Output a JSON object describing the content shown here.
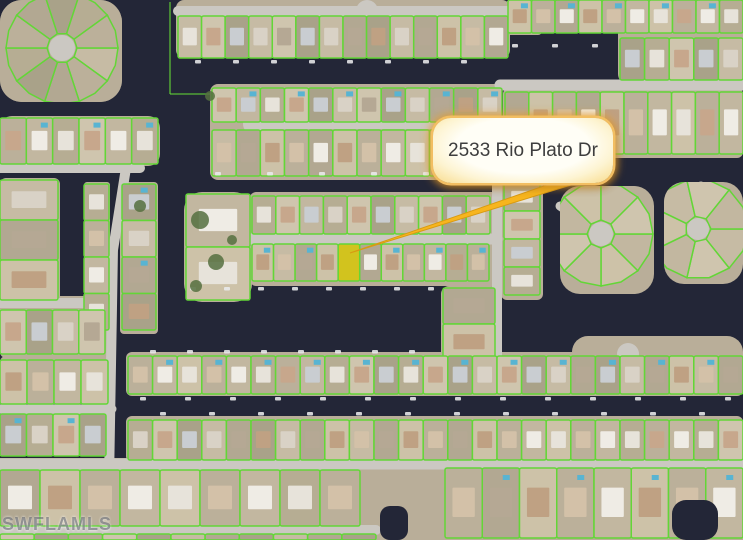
{
  "callout": {
    "label": "2533 Rio Plato Dr"
  },
  "watermark": {
    "text": "SWFLAMLS"
  },
  "map": {
    "width": 743,
    "height": 540,
    "colors": {
      "water": "#232637",
      "street": "#cbc8c2",
      "lot_line": "#63d637",
      "ground": "#b9ae99",
      "lot_fills": [
        "#c6bba4",
        "#bbb09a",
        "#cfc5ae",
        "#b2a892",
        "#c2b7a0",
        "#a9a289",
        "#cdc2a8",
        "#b6ad93"
      ],
      "house_fills": [
        "#e7e3da",
        "#d9d2c6",
        "#d3c1a8",
        "#c7a78c",
        "#b5a894",
        "#efece5",
        "#c9cdd1",
        "#bfa183"
      ],
      "pool": "#58b4d2",
      "boat": "#e9eaec",
      "tree": "#55703f",
      "highlight": "#d4c414",
      "arrow_fill": "#f7b51e",
      "arrow_edge": "#d89a12"
    },
    "ground_rects": [
      [
        0,
        0,
        122,
        102,
        22
      ],
      [
        176,
        0,
        334,
        58,
        8
      ],
      [
        506,
        0,
        36,
        35,
        4
      ],
      [
        544,
        0,
        0,
        0,
        0
      ],
      [
        618,
        0,
        125,
        84,
        10
      ],
      [
        503,
        88,
        240,
        70,
        6
      ],
      [
        210,
        84,
        292,
        96,
        8
      ],
      [
        250,
        192,
        250,
        94,
        6
      ],
      [
        501,
        150,
        42,
        150,
        6
      ],
      [
        441,
        286,
        58,
        76,
        8
      ],
      [
        0,
        116,
        160,
        50,
        12
      ],
      [
        0,
        178,
        60,
        124,
        6
      ],
      [
        84,
        182,
        26,
        150,
        3
      ],
      [
        120,
        182,
        38,
        152,
        4
      ],
      [
        184,
        192,
        68,
        110,
        18
      ],
      [
        0,
        296,
        112,
        62,
        6
      ],
      [
        126,
        352,
        617,
        44,
        6
      ],
      [
        0,
        356,
        110,
        48,
        6
      ],
      [
        126,
        416,
        617,
        46,
        6
      ],
      [
        0,
        410,
        108,
        46,
        6
      ],
      [
        0,
        458,
        743,
        82,
        0
      ],
      [
        572,
        336,
        171,
        58,
        16
      ]
    ],
    "streets": [
      [
        178,
        11,
        508,
        11,
        10
      ],
      [
        253,
        124,
        540,
        124,
        10
      ],
      [
        500,
        85,
        743,
        85,
        11
      ],
      [
        250,
        239,
        497,
        239,
        11
      ],
      [
        0,
        303,
        112,
        303,
        10
      ],
      [
        0,
        464,
        743,
        464,
        11
      ],
      [
        0,
        530,
        376,
        530,
        10
      ],
      [
        0,
        409,
        112,
        409,
        9
      ],
      [
        0,
        168,
        140,
        168,
        10
      ],
      [
        126,
        168,
        113,
        250,
        10
      ],
      [
        113,
        248,
        108,
        540,
        10
      ],
      [
        497,
        150,
        497,
        364,
        10
      ],
      [
        0,
        49,
        50,
        49,
        9
      ],
      [
        560,
        206,
        601,
        234,
        9
      ],
      [
        701,
        186,
        698,
        230,
        9
      ]
    ],
    "bulbs": [
      [
        62,
        48,
        13
      ],
      [
        367,
        11,
        11
      ],
      [
        253,
        124,
        10
      ],
      [
        601,
        234,
        12
      ],
      [
        698,
        230,
        11
      ],
      [
        628,
        354,
        11
      ]
    ],
    "lot_rows": [
      {
        "x": 178,
        "y": 16,
        "w": 330,
        "h": 42,
        "n": 14,
        "o": "h"
      },
      {
        "x": 508,
        "y": 0,
        "w": 235,
        "h": 33,
        "n": 10,
        "o": "h"
      },
      {
        "x": 620,
        "y": 38,
        "w": 123,
        "h": 42,
        "n": 5,
        "o": "h"
      },
      {
        "x": 505,
        "y": 92,
        "w": 238,
        "h": 62,
        "n": 10,
        "o": "h"
      },
      {
        "x": 212,
        "y": 88,
        "w": 290,
        "h": 34,
        "n": 12,
        "o": "h"
      },
      {
        "x": 212,
        "y": 130,
        "w": 290,
        "h": 46,
        "n": 12,
        "o": "h"
      },
      {
        "x": 252,
        "y": 196,
        "w": 238,
        "h": 38,
        "n": 10,
        "o": "h"
      },
      {
        "x": 252,
        "y": 244,
        "w": 237,
        "h": 37,
        "n": 11,
        "o": "h",
        "hl": 4
      },
      {
        "x": 504,
        "y": 155,
        "w": 36,
        "h": 140,
        "n": 5,
        "o": "v"
      },
      {
        "x": 443,
        "y": 288,
        "w": 52,
        "h": 72,
        "n": 2,
        "o": "v"
      },
      {
        "x": 0,
        "y": 118,
        "w": 158,
        "h": 46,
        "n": 6,
        "o": "h"
      },
      {
        "x": 0,
        "y": 180,
        "w": 58,
        "h": 120,
        "n": 3,
        "o": "v"
      },
      {
        "x": 84,
        "y": 184,
        "w": 25,
        "h": 146,
        "n": 4,
        "o": "v"
      },
      {
        "x": 122,
        "y": 184,
        "w": 34,
        "h": 146,
        "n": 4,
        "o": "v"
      },
      {
        "x": 186,
        "y": 194,
        "w": 64,
        "h": 106,
        "n": 2,
        "o": "v"
      },
      {
        "x": 0,
        "y": 310,
        "w": 105,
        "h": 44,
        "n": 4,
        "o": "h"
      },
      {
        "x": 128,
        "y": 356,
        "w": 615,
        "h": 38,
        "n": 25,
        "o": "h"
      },
      {
        "x": 128,
        "y": 420,
        "w": 615,
        "h": 40,
        "n": 25,
        "o": "h"
      },
      {
        "x": 0,
        "y": 360,
        "w": 108,
        "h": 44,
        "n": 4,
        "o": "h"
      },
      {
        "x": 0,
        "y": 414,
        "w": 106,
        "h": 42,
        "n": 4,
        "o": "h"
      },
      {
        "x": 0,
        "y": 470,
        "w": 360,
        "h": 56,
        "n": 9,
        "o": "h"
      },
      {
        "x": 0,
        "y": 534,
        "w": 376,
        "h": 6,
        "n": 11,
        "o": "h"
      },
      {
        "x": 445,
        "y": 468,
        "w": 298,
        "h": 70,
        "n": 8,
        "o": "h"
      }
    ],
    "radial_blocks": [
      {
        "cx": 62,
        "cy": 48,
        "r1": 15,
        "r2": 56,
        "n": 10,
        "clip": [
          0,
          0,
          122,
          102,
          22
        ]
      },
      {
        "cx": 601,
        "cy": 234,
        "r1": 14,
        "r2": 52,
        "n": 8,
        "clip": [
          560,
          186,
          94,
          108,
          20
        ]
      },
      {
        "cx": 698,
        "cy": 229,
        "r1": 13,
        "r2": 50,
        "n": 7,
        "clip": [
          664,
          182,
          79,
          102,
          20
        ]
      }
    ],
    "water_inlets": [
      [
        380,
        506,
        28,
        34,
        10
      ],
      [
        672,
        500,
        46,
        40,
        14
      ]
    ],
    "water_lines": [
      [
        170,
        2,
        170,
        94
      ],
      [
        170,
        94,
        300,
        94
      ]
    ],
    "boat_rows": [
      [
        195,
        60,
        495,
        38
      ],
      [
        512,
        44,
        610,
        40
      ],
      [
        215,
        172,
        488,
        52
      ],
      [
        190,
        287,
        428,
        34
      ],
      [
        150,
        350,
        430,
        37
      ],
      [
        140,
        397,
        730,
        45
      ],
      [
        160,
        412,
        730,
        49
      ]
    ],
    "trees": [
      [
        200,
        220,
        9
      ],
      [
        216,
        262,
        8
      ],
      [
        196,
        286,
        6
      ],
      [
        232,
        240,
        5
      ],
      [
        140,
        206,
        6
      ],
      [
        210,
        96,
        5
      ]
    ],
    "arrow": {
      "base_x": 598,
      "base_y": 172,
      "tip_x": 350,
      "tip_y": 253,
      "base_w": 9
    }
  }
}
